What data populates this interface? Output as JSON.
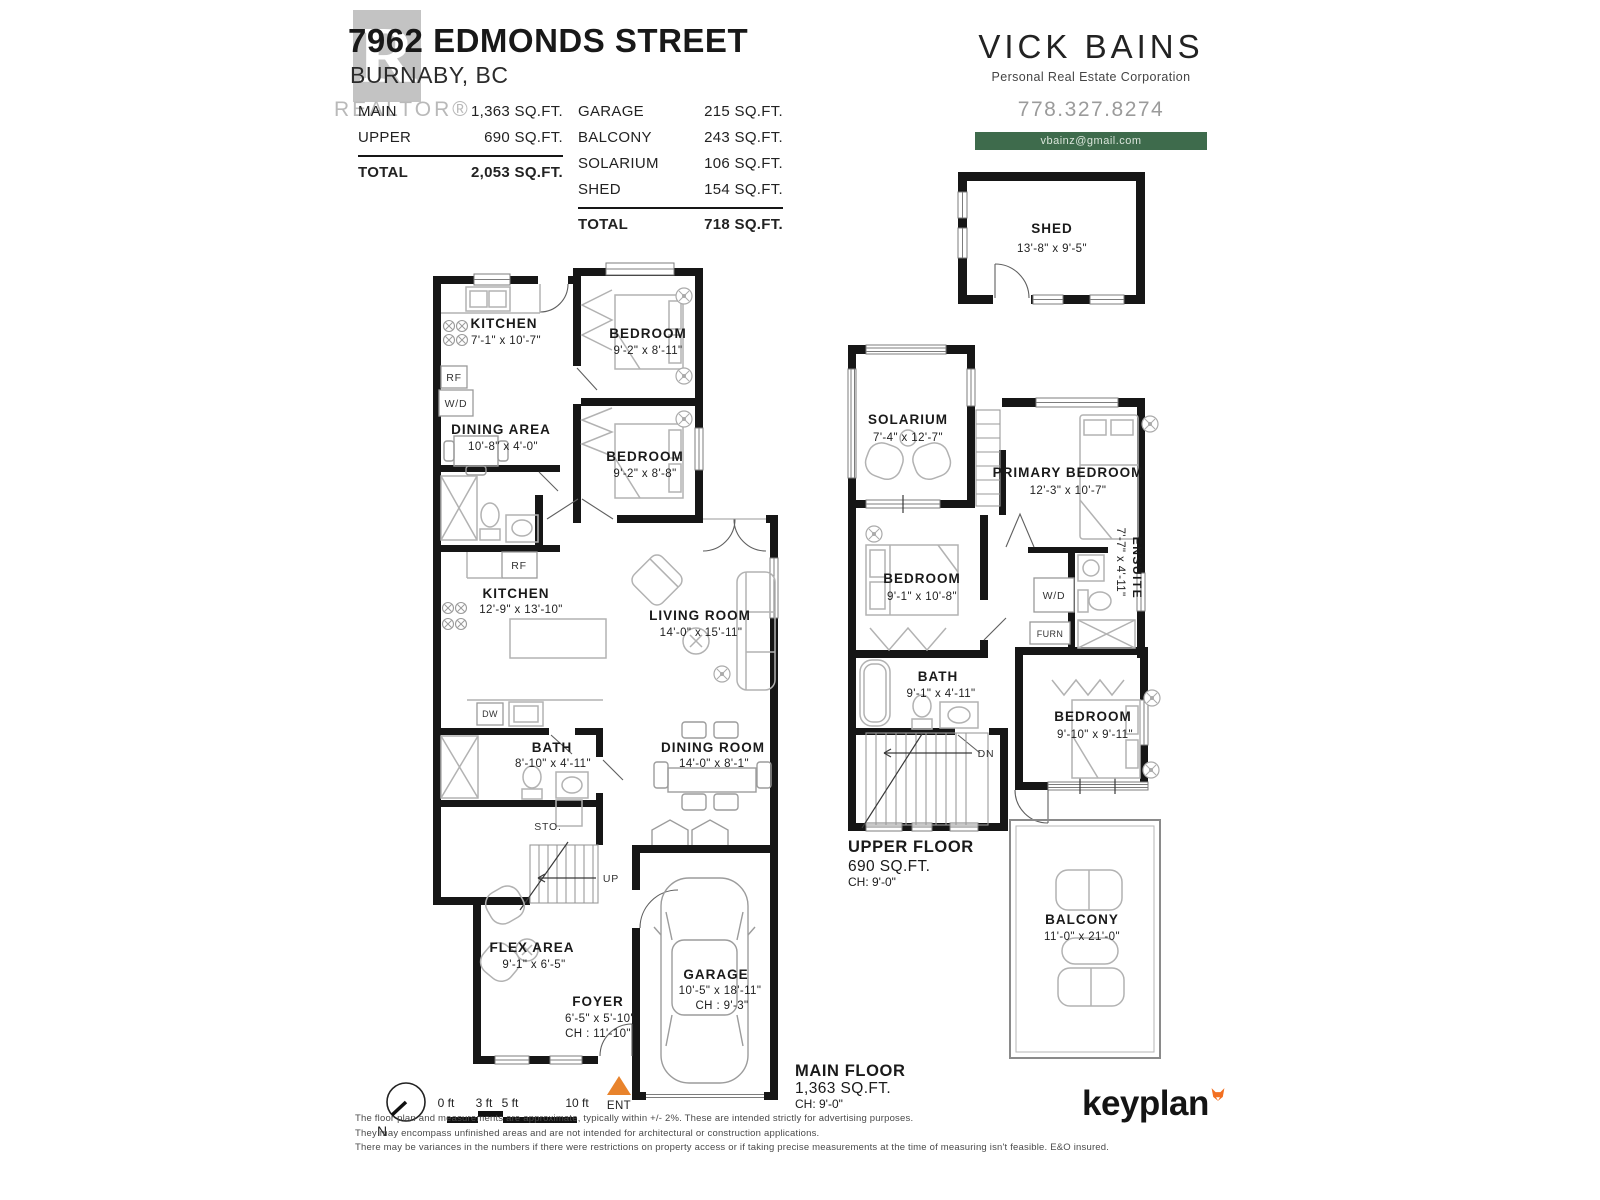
{
  "header": {
    "address_line1": "7962 EDMONDS STREET",
    "address_line2": "BURNABY, BC",
    "realtor_mark": "REALTOR®",
    "realtor_r": "R"
  },
  "area_summary_main": {
    "rows": [
      {
        "label": "MAIN",
        "value": "1,363 SQ.FT."
      },
      {
        "label": "UPPER",
        "value": "690 SQ.FT."
      }
    ],
    "total_label": "TOTAL",
    "total_value": "2,053 SQ.FT."
  },
  "area_summary_other": {
    "rows": [
      {
        "label": "GARAGE",
        "value": "215 SQ.FT."
      },
      {
        "label": "BALCONY",
        "value": "243 SQ.FT."
      },
      {
        "label": "SOLARIUM",
        "value": "106 SQ.FT."
      },
      {
        "label": "SHED",
        "value": "154 SQ.FT."
      }
    ],
    "total_label": "TOTAL",
    "total_value": "718 SQ.FT."
  },
  "agent": {
    "name": "VICK BAINS",
    "subtitle": "Personal Real Estate Corporation",
    "phone": "778.327.8274",
    "email": "vbainz@gmail.com"
  },
  "shed": {
    "name": "SHED",
    "dims": "13'-8\" x 9'-5\""
  },
  "main_floor": {
    "floor_title": "MAIN FLOOR",
    "floor_area": "1,363 SQ.FT.",
    "floor_ch": "CH: 9'-0\"",
    "rooms": {
      "kitchen_upper": {
        "name": "KITCHEN",
        "dims": "7'-1\" x 10'-7\""
      },
      "dining_area": {
        "name": "DINING AREA",
        "dims": "10'-8\" x 4'-0\""
      },
      "bedroom_top": {
        "name": "BEDROOM",
        "dims": "9'-2\" x 8'-11\""
      },
      "bedroom_mid": {
        "name": "BEDROOM",
        "dims": "9'-2\" x 8'-8\""
      },
      "kitchen_main": {
        "name": "KITCHEN",
        "dims": "12'-9\" x 13'-10\""
      },
      "living_room": {
        "name": "LIVING ROOM",
        "dims": "14'-0\" x 15'-11\""
      },
      "bath": {
        "name": "BATH",
        "dims": "8'-10\" x 4'-11\""
      },
      "dining_room": {
        "name": "DINING ROOM",
        "dims": "14'-0\" x 8'-1\""
      },
      "flex_area": {
        "name": "FLEX AREA",
        "dims": "9'-1\" x 6'-5\""
      },
      "foyer": {
        "name": "FOYER",
        "dims": "6'-5\" x 5'-10\"",
        "ch": "CH : 11'-10\""
      },
      "garage": {
        "name": "GARAGE",
        "dims": "10'-5\" x 18'-11\"",
        "ch": "CH : 9'-3\""
      }
    },
    "tags": {
      "rf_upper": "RF",
      "wd": "W/D",
      "rf_main": "RF",
      "dw": "DW",
      "sto": "STO.",
      "up": "UP"
    }
  },
  "upper_floor": {
    "floor_title": "UPPER FLOOR",
    "floor_area": "690 SQ.FT.",
    "floor_ch": "CH: 9'-0\"",
    "rooms": {
      "solarium": {
        "name": "SOLARIUM",
        "dims": "7'-4\" x 12'-7\""
      },
      "primary_bedroom": {
        "name": "PRIMARY BEDROOM",
        "dims": "12'-3\" x 10'-7\""
      },
      "bedroom_left": {
        "name": "BEDROOM",
        "dims": "9'-1\" x 10'-8\""
      },
      "ensuite": {
        "name": "ENSUITE",
        "dims": "7'-7\" x 4'-11\""
      },
      "bath": {
        "name": "BATH",
        "dims": "9'-1\" x 4'-11\""
      },
      "bedroom_right": {
        "name": "BEDROOM",
        "dims": "9'-10\" x 9'-11\""
      },
      "balcony": {
        "name": "BALCONY",
        "dims": "11'-0\" x 21'-0\""
      }
    },
    "tags": {
      "wd": "W/D",
      "furn": "FURN",
      "dn": "DN"
    }
  },
  "plan_markers": {
    "ent": "ENT",
    "north": "N"
  },
  "scale_bar": {
    "labels": [
      "0 ft",
      "3 ft",
      "5 ft",
      "10 ft"
    ]
  },
  "footer": {
    "disclaimer": [
      "The floor plan and measurements are approximate, typically within +/- 2%. These are intended strictly for advertising purposes.",
      "They may encompass unfinished areas and are not intended for architectural or construction applications.",
      "There may be variances in the numbers if there were restrictions on property access or if taking precise measurements at the time of measuring isn't feasible. E&O insured."
    ],
    "logo_text": "keyplan"
  }
}
